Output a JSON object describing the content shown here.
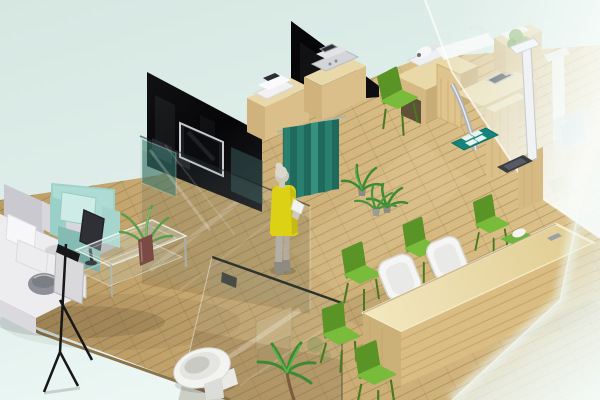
{
  "scene": {
    "type": "3d-isometric-interior-render",
    "setting": "clinic / office interior floor-plan visualization",
    "visible_text": "none",
    "canvas": {
      "width": 600,
      "height": 400
    }
  },
  "palette": {
    "mint_bg_top": "#d6e7e2",
    "mint_bg_bottom": "#ecf7f4",
    "floor_dark": "#b3945f",
    "floor_mid": "#cbad75",
    "floor_light": "#e2cc94",
    "floor_edge": "#8b734a",
    "wall_black": "#08080a",
    "wall_black_soft": "#1c1c21",
    "tv_frame": "#c9ccce",
    "tv_screen": "#0a0c0f",
    "teal_panel": "rgba(43,115,105,0.55)",
    "teal_panel2": "rgba(60,100,95,0.45)",
    "curtain_a": "#2b7f6f",
    "curtain_b": "#1f6a5c",
    "curtain_hi": "#37917e",
    "curtain_rail": "#a9b7b1",
    "person_dress": "#ddd116",
    "person_skin": "#cfc9bd",
    "person_hair": "#ddd7cb",
    "person_pants": "#b3aea6",
    "person_boots": "#8f8a82",
    "person_paper": "#f2f2ee",
    "cabinet_top": "#e8d8aa",
    "cabinet_front": "#cfb27c",
    "cabinet_side": "#dbbf8a",
    "device_white": "#f1f1f4",
    "device_gray": "#d4d5d8",
    "device_screen": "#2b2e33",
    "desk_top": "#ead9a8",
    "desk_front": "#d5b983",
    "desk_side": "#c9ad76",
    "desk_grain": "#c6a86a",
    "kneehole": "#5f5038",
    "chrome": "#aeb3b8",
    "mat_teal": "#15847c",
    "mat_square": "#e8f2ef",
    "scale_dark": "#393d43",
    "stadiometer_white": "#f0f2f3",
    "chair_green": "#79bb3a",
    "chair_green_dark": "#5a9427",
    "chair_leg": "#47791d",
    "reception_front": "#d9bd82",
    "reception_side": "#cbb078",
    "reception_stripe": "#c4a468",
    "reception_hi": "#f6ecc8",
    "office_chair_white": "#f5f5f4",
    "tray_green": "#72b440",
    "sofa_base": "#ededf0",
    "sofa_gray": "#c9c9cf",
    "sofa_gray2": "#d6d6db",
    "sofa_front": "#c6c6cc",
    "sofa_pillow": "#f7f7f9",
    "armchair_mint": "#aedcd5",
    "armchair_mint_light": "#cdece6",
    "armchair_mint_dark": "#85bbb2",
    "monitor_dark": "#2e3036",
    "toilet_white": "#f3f3f1",
    "toilet_seat": "#e4e4e0",
    "toilet_inner": "#cacac5",
    "plant_green": "#3e8a33",
    "plant_green_light": "#5fae4e",
    "plant_pot": "#7c4a44",
    "wood_crate": "#cdb584",
    "bowl_gray": "#8e9098",
    "easel_black": "#17171a",
    "easel_panel": "#d9d9dc",
    "frost": "#f2faf7"
  },
  "objects": [
    {
      "name": "background",
      "label": "pale mint backdrop around the room",
      "position": "edges"
    },
    {
      "name": "wood-floor",
      "label": "light wood plank floor laid diagonally",
      "position": "whole room"
    },
    {
      "name": "black-wall-left",
      "label": "dark glass partition wall with mounted TV",
      "position": "upper left"
    },
    {
      "name": "tv",
      "label": "flat screen TV on dark wall",
      "position": "upper left"
    },
    {
      "name": "teal-glass-panels",
      "label": "teal tinted glass inserts",
      "position": "left partition"
    },
    {
      "name": "glass-partition",
      "label": "clear glass partition reflecting the floor",
      "position": "center left"
    },
    {
      "name": "black-wall-center",
      "label": "dark glass partition wall",
      "position": "top center"
    },
    {
      "name": "cabinet-device-left",
      "label": "wood cabinet with white tabletop machine",
      "position": "center"
    },
    {
      "name": "cabinet-device-right",
      "label": "wood cabinet with gray machine and small screen",
      "position": "center"
    },
    {
      "name": "curtain",
      "label": "teal privacy curtain hanging from rail",
      "position": "center"
    },
    {
      "name": "person",
      "label": "woman in yellow top holding papers at the curtain",
      "position": "center"
    },
    {
      "name": "floor-plants-small",
      "label": "two small spiky floor plants",
      "count": 2,
      "position": "center right"
    },
    {
      "name": "exam-desk",
      "label": "L-shaped wooden examination desk with instruments",
      "position": "upper right room"
    },
    {
      "name": "white-instrument",
      "label": "white tabletop instrument on tray",
      "position": "exam desk"
    },
    {
      "name": "embedded-screen",
      "label": "small dark screen embedded in desk",
      "position": "exam desk"
    },
    {
      "name": "chrome-pipe",
      "label": "curved chrome tube",
      "position": "exam desk"
    },
    {
      "name": "green-chair-exam",
      "label": "green chair at exam desk",
      "position": "upper right room"
    },
    {
      "name": "teal-mat",
      "label": "teal floor mat with four white pads",
      "position": "upper right room"
    },
    {
      "name": "weighing-scale",
      "label": "dark weighing scale platform",
      "position": "right"
    },
    {
      "name": "stadiometer",
      "label": "white height measuring stand on wooden base",
      "position": "right"
    },
    {
      "name": "sink-behind-frost",
      "label": "white basin counter seen through frosted glass",
      "position": "top right"
    },
    {
      "name": "frosted-wall-right",
      "label": "tall frosted glass wall with faint furniture behind",
      "position": "right"
    },
    {
      "name": "frosted-pane-foreground",
      "label": "frosted pane fading the lower right corner",
      "position": "bottom right"
    },
    {
      "name": "sofa",
      "label": "light gray L-shaped sofa with cushions and pillows",
      "position": "left"
    },
    {
      "name": "bowl",
      "label": "gray bowl resting on sofa seat",
      "position": "left"
    },
    {
      "name": "armchair",
      "label": "mint green armchair with pillow",
      "position": "left"
    },
    {
      "name": "monitor",
      "label": "dark display facing the armchair",
      "position": "left"
    },
    {
      "name": "coffee-table",
      "label": "glass coffee table with red-brown vase and plant",
      "position": "center left"
    },
    {
      "name": "easel-stand",
      "label": "black tripod stand with white panel",
      "position": "lower left"
    },
    {
      "name": "restroom-door",
      "label": "glass door with dark handle in front of toilet",
      "position": "bottom center"
    },
    {
      "name": "toilet",
      "label": "white toilet",
      "position": "bottom center"
    },
    {
      "name": "storage-crates",
      "label": "stacked wooden crates behind glass",
      "position": "bottom center"
    },
    {
      "name": "floor-plant-large",
      "label": "leafy potted plant",
      "position": "bottom center"
    },
    {
      "name": "reception-desk",
      "label": "long light wood reception counter",
      "position": "bottom right"
    },
    {
      "name": "office-chairs",
      "label": "white office chairs behind the counter",
      "count": 2,
      "position": "bottom right"
    },
    {
      "name": "visitor-chairs",
      "label": "green visitor chairs around the counter",
      "count": 5,
      "position": "bottom right"
    },
    {
      "name": "desk-tray",
      "label": "green tray with white object on counter",
      "position": "bottom right"
    },
    {
      "name": "desk-phone",
      "label": "small gray object on counter",
      "position": "bottom right"
    },
    {
      "name": "reception-plant",
      "label": "small green plant near waiting chairs",
      "position": "center right"
    }
  ]
}
